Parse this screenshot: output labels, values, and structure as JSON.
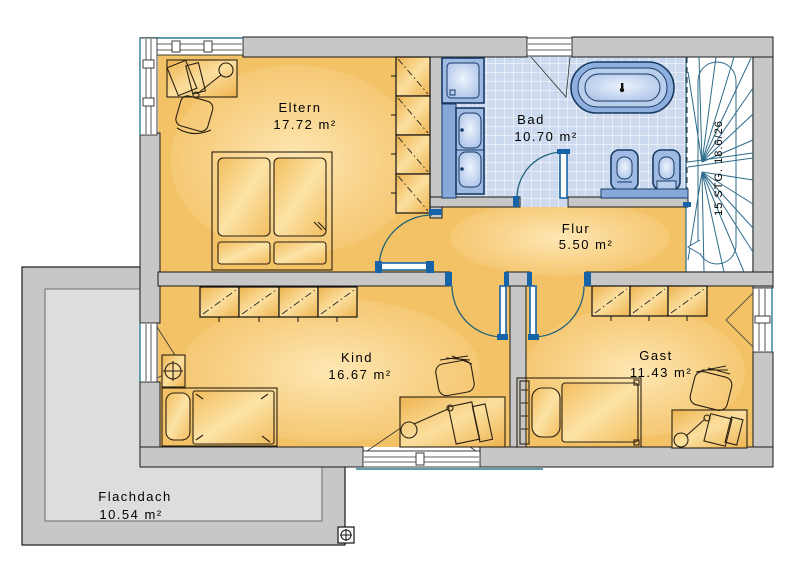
{
  "plan": {
    "title": "Obergeschoss Grundriss",
    "rooms": {
      "eltern": {
        "name": "Eltern",
        "area": "17.72 m²"
      },
      "bad": {
        "name": "Bad",
        "area": "10.70 m²"
      },
      "flur": {
        "name": "Flur",
        "area": "5.50 m²"
      },
      "kind": {
        "name": "Kind",
        "area": "16.67 m²"
      },
      "gast": {
        "name": "Gast",
        "area": "11.43 m²"
      },
      "flachdach": {
        "name": "Flachdach",
        "area": "10.54 m²"
      }
    },
    "stairs": {
      "label": "15 STG. 18.6/26"
    },
    "colors": {
      "wall_gray": "#c7c7c7",
      "flachdach_inner": "#dddddd",
      "room_orange": "#f3c267",
      "room_highlight": "#ffe9b8",
      "tile_blue": "#ccd9ee",
      "fixture_blue": "#9fbbe3",
      "fixture_dark_blue": "#173a63",
      "door_frame_blue": "#1663a8",
      "door_arc_teal": "#1f6277",
      "stair_blue": "#2e6b8a",
      "window_sill_teal": "#2b7f8f"
    }
  }
}
